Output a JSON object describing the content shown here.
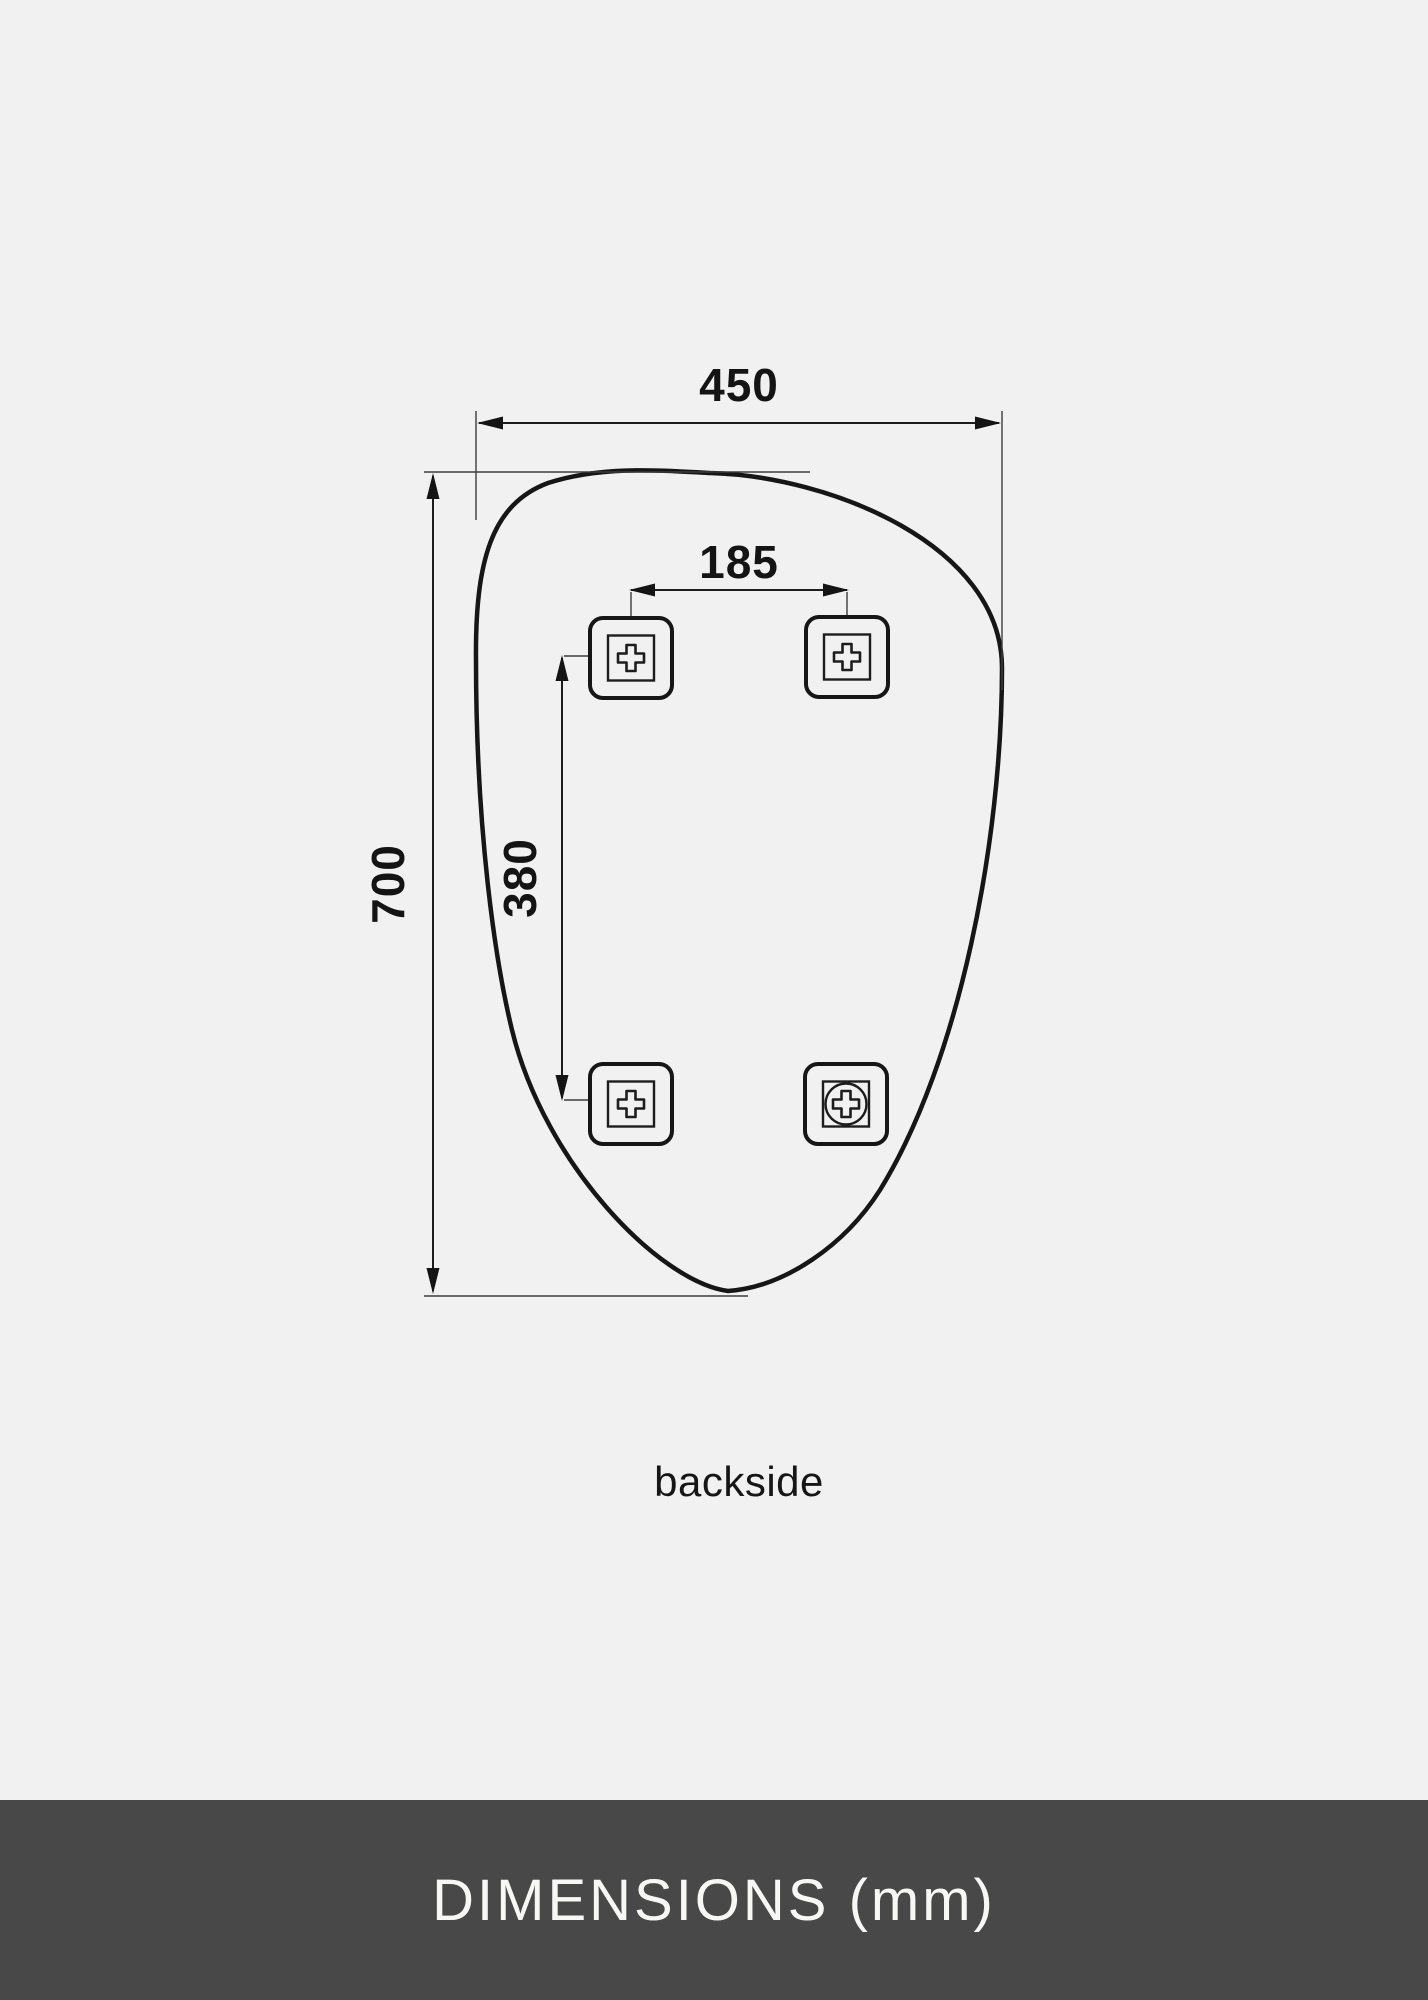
{
  "drawing": {
    "view_label": "backside",
    "dimensions": {
      "width": "450",
      "height": "700",
      "bracket_spacing_horizontal": "185",
      "bracket_spacing_vertical": "380"
    },
    "icons": {
      "mounting_bracket": "rounded-square-with-cross",
      "mounting_bracket_screw": "rounded-square-with-circled-cross"
    }
  },
  "footer": {
    "title": "DIMENSIONS (mm)"
  },
  "colors": {
    "background": "#f1f1f2",
    "line": "#161616",
    "footer_background": "#484848",
    "footer_text": "#f7f7f6"
  }
}
